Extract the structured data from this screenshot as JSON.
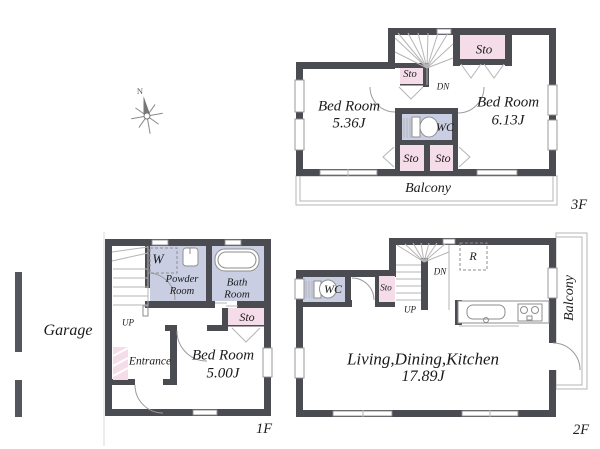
{
  "colors": {
    "wall": "#4b4b52",
    "storage_pink": "#f5dce9",
    "wet_area_lavender": "#c9cee3"
  },
  "compass": {
    "north": "N"
  },
  "f3": {
    "floor_label": "3F",
    "bedroom_a_name": "Bed Room",
    "bedroom_a_size": "5.36J",
    "bedroom_b_name": "Bed Room",
    "bedroom_b_size": "6.13J",
    "wc": "WC",
    "sto_a": "Sto",
    "sto_b": "Sto",
    "sto_c": "Sto",
    "sto_d": "Sto",
    "dn": "DN",
    "balcony": "Balcony"
  },
  "f2": {
    "floor_label": "2F",
    "ldk_name": "Living,Dining,Kitchen",
    "ldk_size": "17.89J",
    "wc": "WC",
    "sto": "Sto",
    "fridge": "R",
    "up": "UP",
    "dn": "DN",
    "balcony": "Balcony"
  },
  "f1": {
    "floor_label": "1F",
    "bedroom_name": "Bed Room",
    "bedroom_size": "5.00J",
    "powder_room_line1": "Powder",
    "powder_room_line2": "Room",
    "bath_room_line1": "Bath",
    "bath_room_line2": "Room",
    "washer": "W",
    "sto": "Sto",
    "entrance": "Entrance",
    "garage": "Garage",
    "up": "UP"
  }
}
